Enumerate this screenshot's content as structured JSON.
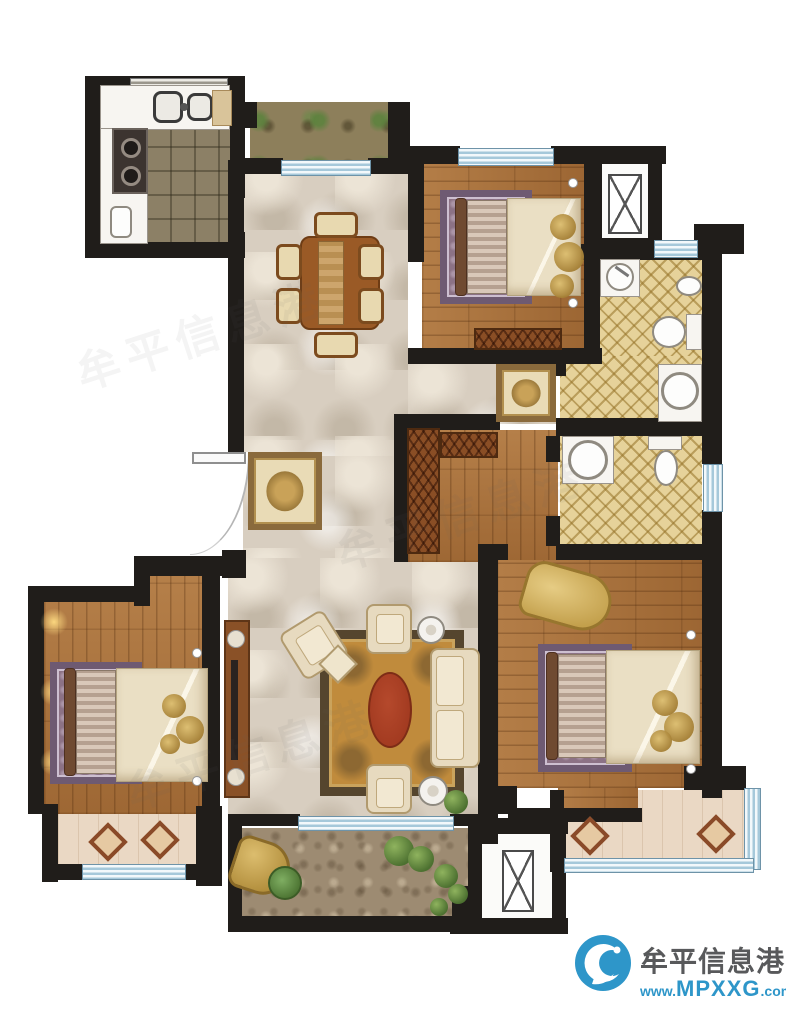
{
  "watermark": {
    "site_name": "牟平信息港",
    "url_prefix": "www.",
    "url_domain": "MPXXG",
    "url_tld": ".com"
  },
  "colors": {
    "wall": "#201d1a",
    "marble": "#d8cec0",
    "marbleLight": "#ece4d6",
    "wood": "#a9713b",
    "kitchenTile": "#8c8066",
    "bathTile": "#e6d29a",
    "windowBlue": "#a5c8da",
    "balconyFloor": "#ead8c4",
    "terraceFloor": "#9d8b72",
    "rugGold": "#c08b3c",
    "rugRed": "#a23a20",
    "bedRug": "#8c7285",
    "bedStripeA": "#d9c8b9",
    "bedStripeB": "#b5a090",
    "blanket": "#eadfc4",
    "cream": "#e7dabf",
    "tableBrown": "#9a5a26",
    "chairBeige": "#e8d9b0",
    "cabinetBrown": "#8a5127",
    "fixtureWhite": "#f7f5f1",
    "plantGreen": "#5f8743",
    "soil": "#8d7f5b",
    "logoBlue": "#2e96c9",
    "textGray": "#58595b"
  }
}
